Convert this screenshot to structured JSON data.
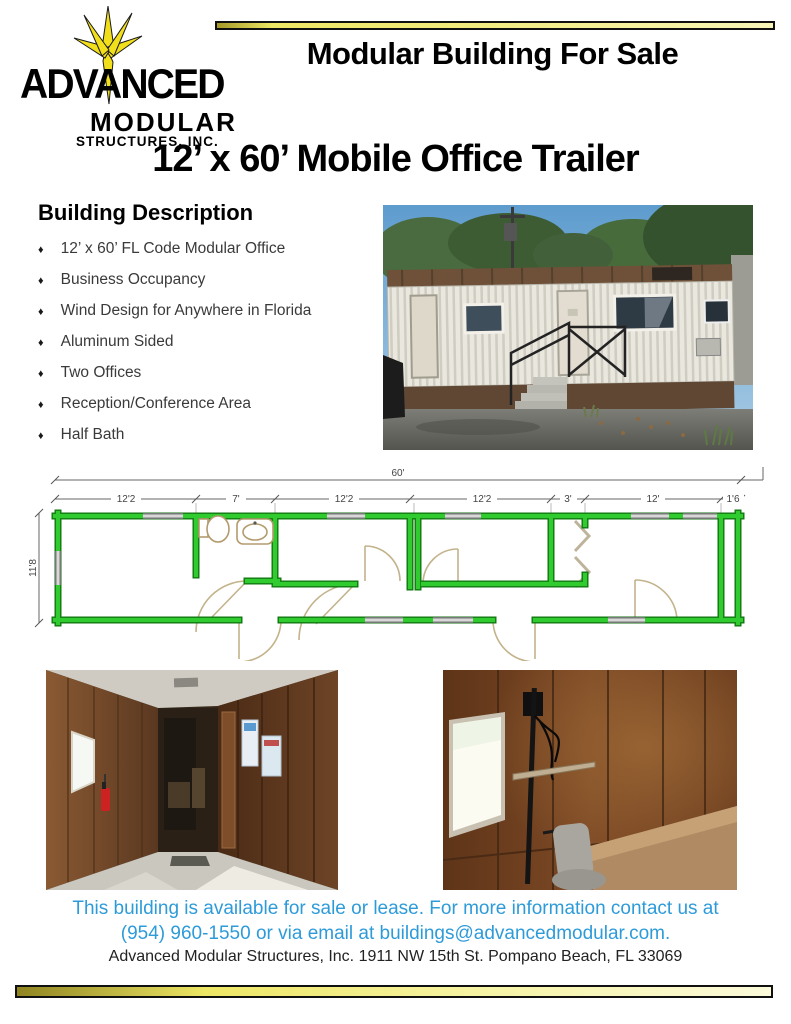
{
  "brand": {
    "logo_line1": "ADVANCED",
    "logo_line2": "MODULAR",
    "logo_line3": "STRUCTURES, INC.",
    "star_color": "#F2DF1C"
  },
  "header": {
    "banner_title": "Modular Building For Sale"
  },
  "main_title": "12’ x 60’ Mobile Office Trailer",
  "description": {
    "heading": "Building Description",
    "bullet_char": "♦",
    "items": [
      "12’ x 60’ FL Code Modular Office",
      "Business Occupancy",
      "Wind Design for Anywhere in Florida",
      "Aluminum Sided",
      "Two Offices",
      "Reception/Conference Area",
      "Half Bath"
    ]
  },
  "floor_plan": {
    "overall_width_label": "60'",
    "left_depth_label": "11'8",
    "segment_labels": [
      "12'2",
      "7'",
      "12'2",
      "12'2",
      "3'",
      "12'",
      "1'6"
    ],
    "wall_color": "#2FCB2F"
  },
  "footer": {
    "line1": "This building is available for sale or lease. For more information contact us at",
    "line2": "(954) 960-1550 or via email at buildings@advancedmodular.com.",
    "address": "Advanced Modular Structures, Inc. 1911 NW 15th St. Pompano Beach, FL 33069",
    "text_color": "#2E9BD9"
  },
  "colors": {
    "accent_gold_dark": "#9A8E22",
    "accent_gold_light": "#FBF9D2"
  }
}
